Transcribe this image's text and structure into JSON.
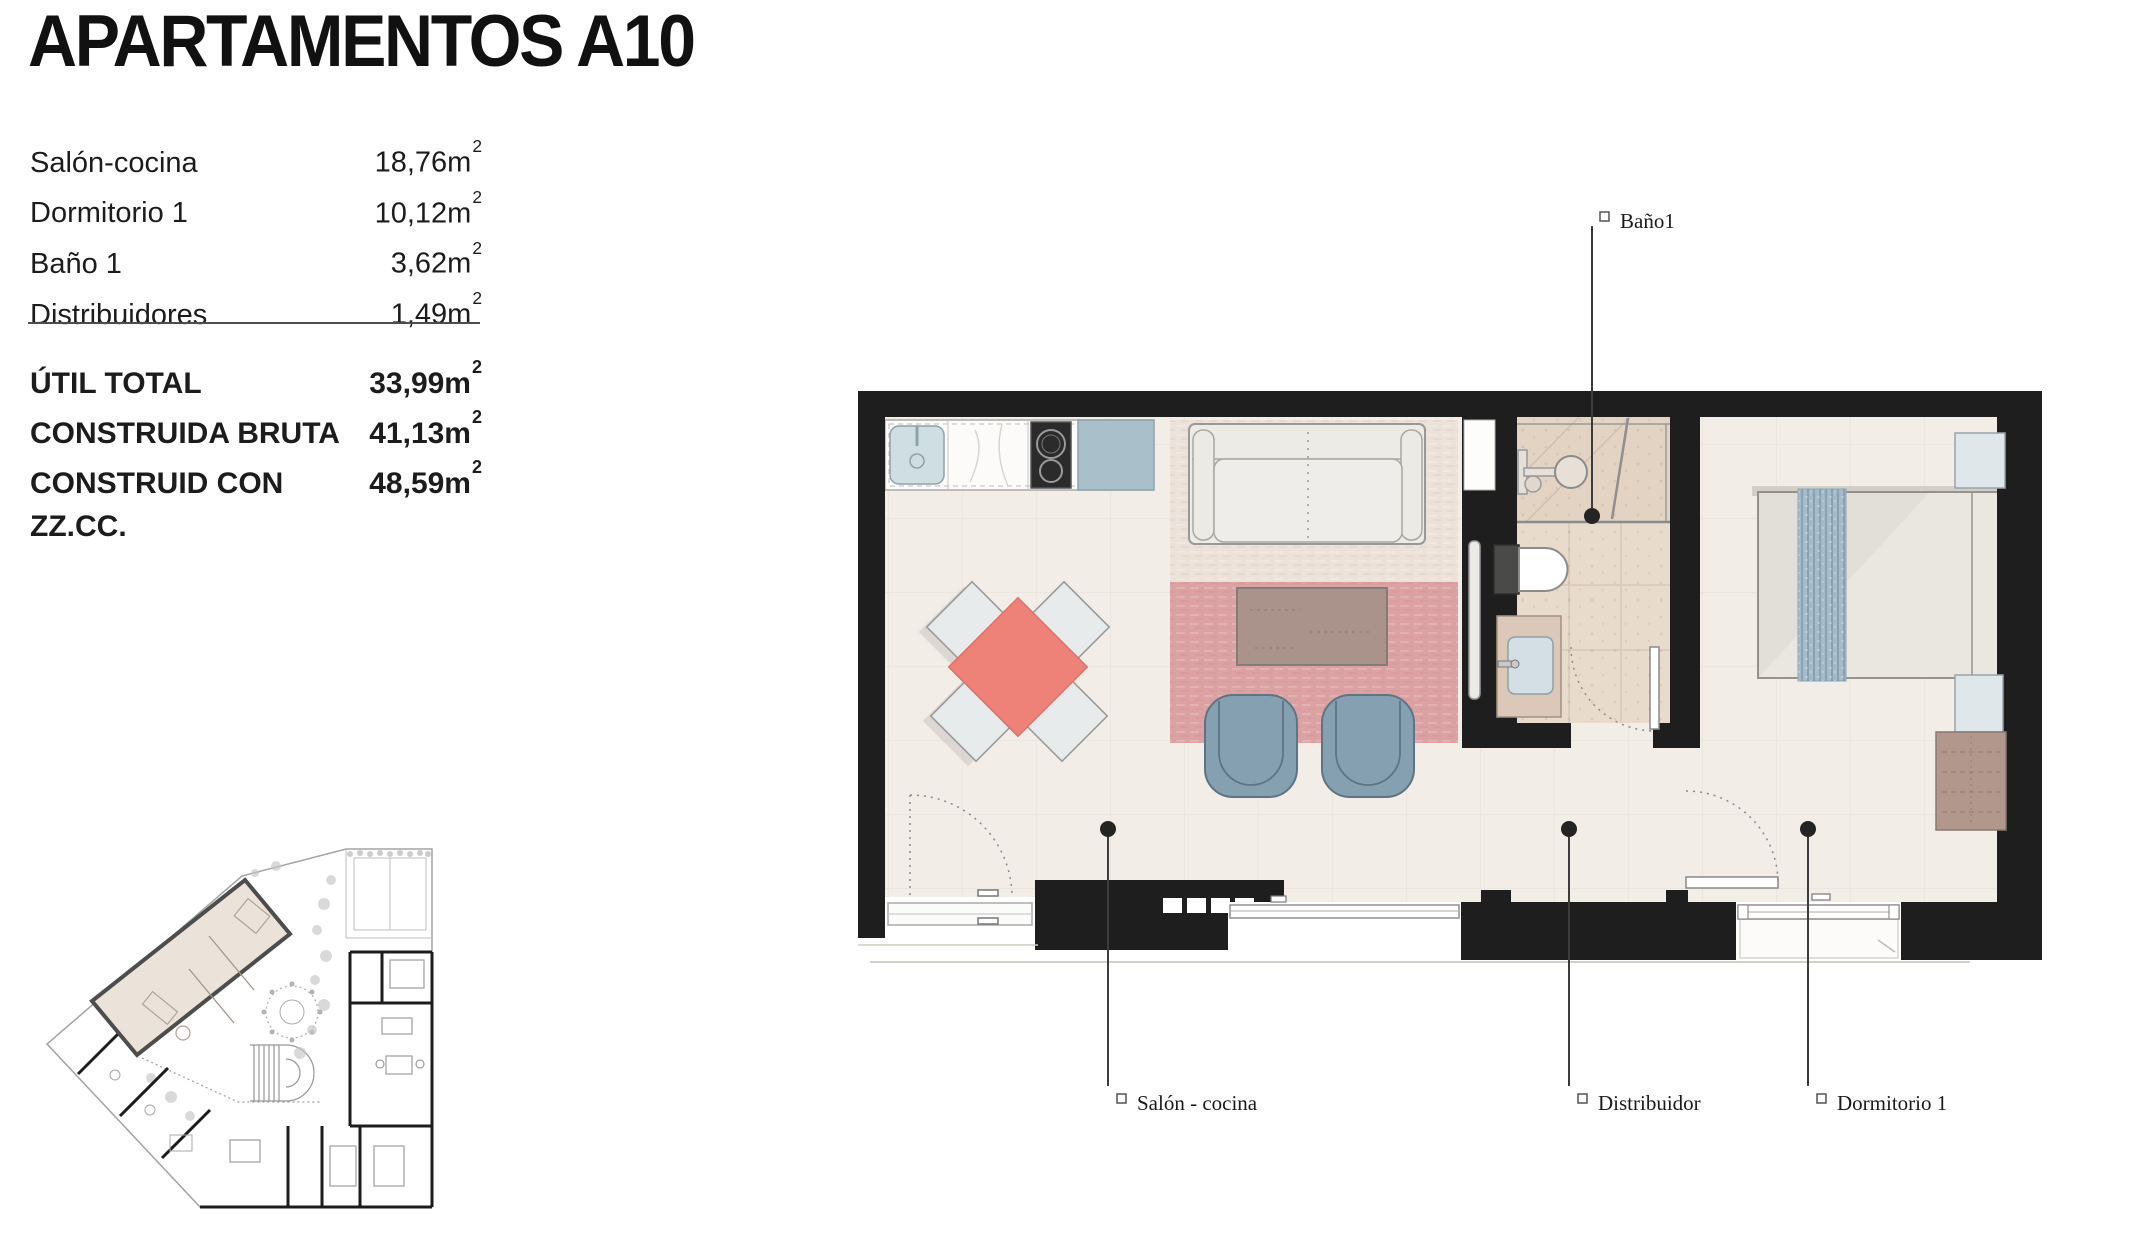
{
  "title": "APARTAMENTOS A10",
  "sidebar": {
    "sup": "2",
    "rooms": [
      {
        "label": "Salón-cocina",
        "value": "18,76m"
      },
      {
        "label": "Dormitorio 1",
        "value": "10,12m"
      },
      {
        "label": "Baño 1",
        "value": "3,62m"
      },
      {
        "label": "Distribuidores",
        "value": "1,49m"
      }
    ],
    "totals": [
      {
        "label": "ÚTIL TOTAL",
        "value": "33,99m"
      },
      {
        "label": "CONSTRUIDA BRUTA",
        "value": "41,13m"
      },
      {
        "label": "CONSTRUID CON ZZ.CC.",
        "value": "48,59m"
      }
    ]
  },
  "plan": {
    "labels": {
      "bathroom": "Baño1",
      "living": "Salón - cocina",
      "hall": "Distribuidor",
      "bedroom": "Dormitorio 1"
    }
  },
  "colors": {
    "wall": "#1e1e1e",
    "floor": "#f2ede7",
    "bath_floor": "#e9dbcb",
    "table_red": "#ef8278",
    "rug_pink": "#dca1a3",
    "rug_top": "#ece2d9",
    "armchair_blue": "#84a0b1",
    "wood_brown": "#a9938b",
    "bed_runner": "#a6bbc9",
    "appliance_blue": "#a9bfc9"
  }
}
